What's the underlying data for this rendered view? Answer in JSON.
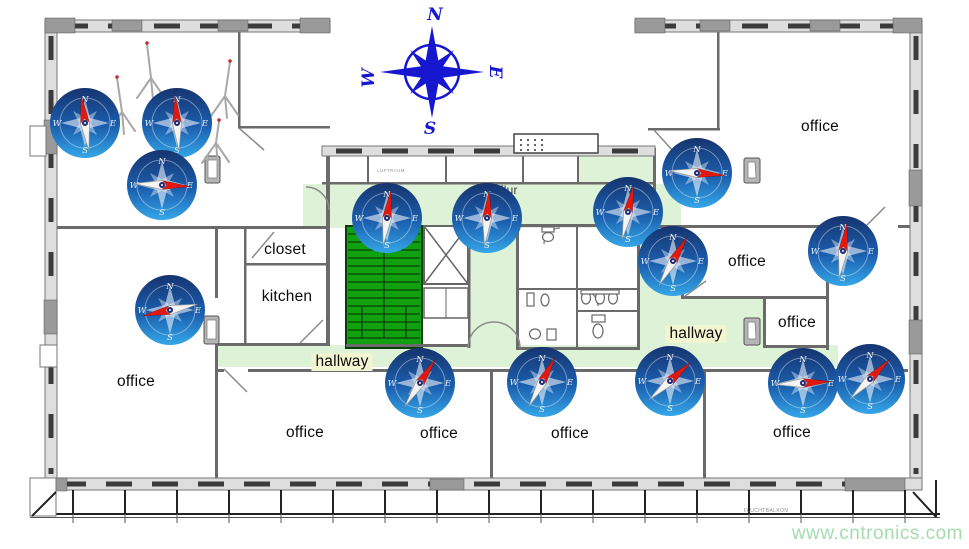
{
  "colors": {
    "hallway_green": "#ddf2d6",
    "label_highlight": "#f2f6d0",
    "stair_green": "#10a010",
    "stair_border": "#073f07",
    "compass_navy": "#16346f",
    "compass_mid": "#1b5fae",
    "compass_blue": "#35a7e8",
    "needle_red": "#e01810",
    "rose_blue": "#1717cf",
    "watermark_green": "#a4dcae"
  },
  "north_rose": {
    "x": 432,
    "y": 72,
    "letters": {
      "n": "N",
      "e": "E",
      "s": "S",
      "w": "W"
    }
  },
  "compass_letters": {
    "n": "N",
    "e": "E",
    "s": "S",
    "w": "W"
  },
  "rooms": [
    {
      "id": "office-top-right",
      "label": "office",
      "x": 820,
      "y": 127
    },
    {
      "id": "office-left",
      "label": "office",
      "x": 136,
      "y": 382
    },
    {
      "id": "office-bottom-1",
      "label": "office",
      "x": 305,
      "y": 433
    },
    {
      "id": "office-bottom-2",
      "label": "office",
      "x": 439,
      "y": 434
    },
    {
      "id": "office-bottom-3",
      "label": "office",
      "x": 570,
      "y": 434
    },
    {
      "id": "office-bottom-4",
      "label": "office",
      "x": 792,
      "y": 433
    },
    {
      "id": "office-mid-right",
      "label": "office",
      "x": 747,
      "y": 262
    },
    {
      "id": "office-small-right",
      "label": "office",
      "x": 797,
      "y": 323
    },
    {
      "id": "closet",
      "label": "closet",
      "x": 285,
      "y": 250
    },
    {
      "id": "kitchen",
      "label": "kitchen",
      "x": 287,
      "y": 297
    },
    {
      "id": "hallway-bottom",
      "label": "hallway",
      "x": 342,
      "y": 362,
      "highlight": true
    },
    {
      "id": "hallway-right",
      "label": "hallway",
      "x": 696,
      "y": 334,
      "highlight": true
    },
    {
      "id": "flur",
      "label": "Flur",
      "x": 507,
      "y": 190,
      "small": true
    }
  ],
  "tiny_labels": [
    {
      "text": "LUFTRAUM",
      "x": 391,
      "y": 172,
      "size": 4.5
    },
    {
      "text": "FLUCHTBALKON",
      "x": 766,
      "y": 512,
      "size": 5
    }
  ],
  "compasses": [
    {
      "x": 85,
      "y": 123,
      "angle": -8
    },
    {
      "x": 177,
      "y": 123,
      "angle": -4
    },
    {
      "x": 162,
      "y": 185,
      "angle": 93
    },
    {
      "x": 170,
      "y": 310,
      "angle": -102
    },
    {
      "x": 387,
      "y": 218,
      "angle": 8
    },
    {
      "x": 487,
      "y": 218,
      "angle": 5
    },
    {
      "x": 628,
      "y": 212,
      "angle": 12
    },
    {
      "x": 673,
      "y": 261,
      "angle": 30
    },
    {
      "x": 697,
      "y": 173,
      "angle": 95
    },
    {
      "x": 843,
      "y": 251,
      "angle": 8
    },
    {
      "x": 420,
      "y": 383,
      "angle": 33
    },
    {
      "x": 542,
      "y": 382,
      "angle": 28
    },
    {
      "x": 670,
      "y": 381,
      "angle": 48
    },
    {
      "x": 803,
      "y": 383,
      "angle": 87
    },
    {
      "x": 870,
      "y": 379,
      "angle": 45
    }
  ],
  "tripods": [
    {
      "apex_x": 122,
      "apex_y": 112,
      "top_x": 117,
      "top_y": 78
    },
    {
      "apex_x": 151,
      "apex_y": 78,
      "top_x": 147,
      "top_y": 44
    },
    {
      "apex_x": 225,
      "apex_y": 96,
      "top_x": 230,
      "top_y": 62
    },
    {
      "apex_x": 216,
      "apex_y": 143,
      "top_x": 219,
      "top_y": 121
    }
  ],
  "watermark": {
    "text": "www.cntronics.com"
  }
}
